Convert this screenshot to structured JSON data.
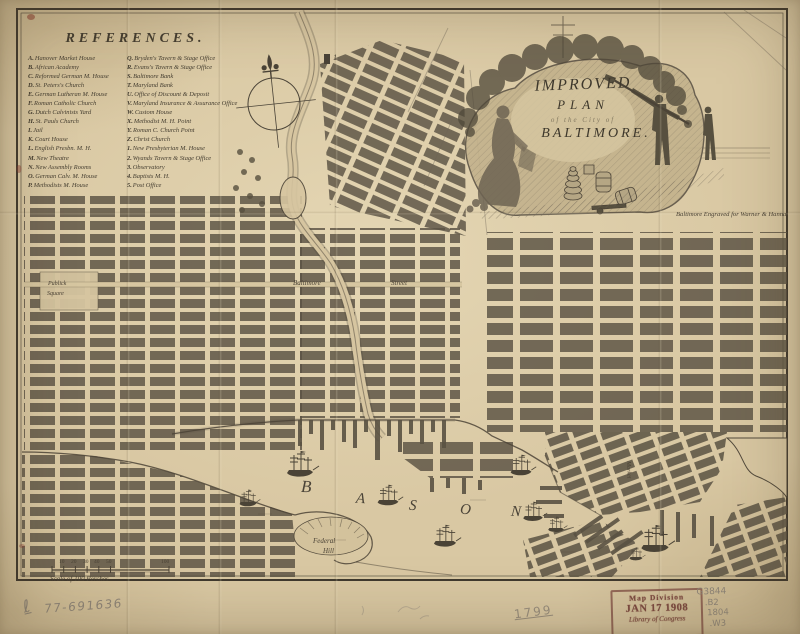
{
  "references": {
    "title": "REFERENCES.",
    "left": [
      {
        "key": "A.",
        "label": "Hanover Market House"
      },
      {
        "key": "B.",
        "label": "African Academy"
      },
      {
        "key": "C.",
        "label": "Reformed German M. House"
      },
      {
        "key": "D.",
        "label": "St. Peters's Church"
      },
      {
        "key": "E.",
        "label": "German Lutheran M. House"
      },
      {
        "key": "F.",
        "label": "Roman Catholic Church"
      },
      {
        "key": "G.",
        "label": "Dutch Calvinists Yard"
      },
      {
        "key": "H.",
        "label": "St. Pauls Church"
      },
      {
        "key": "I.",
        "label": "Jail"
      },
      {
        "key": "K.",
        "label": "Court House"
      },
      {
        "key": "L.",
        "label": "English Presbn. M. H."
      },
      {
        "key": "M.",
        "label": "New Theatre"
      },
      {
        "key": "N.",
        "label": "New Assembly Rooms"
      },
      {
        "key": "O.",
        "label": "German Calv. M. House"
      },
      {
        "key": "P.",
        "label": "Methodists M. House"
      }
    ],
    "right": [
      {
        "key": "Q.",
        "label": "Bryden's Tavern & Stage Office"
      },
      {
        "key": "R.",
        "label": "Evans's Tavern & Stage Office"
      },
      {
        "key": "S.",
        "label": "Baltimore Bank"
      },
      {
        "key": "T.",
        "label": "Maryland Bank"
      },
      {
        "key": "U.",
        "label": "Office of Discount & Deposit"
      },
      {
        "key": "V.",
        "label": "Maryland Insurance & Assurance Office"
      },
      {
        "key": "W.",
        "label": "Custom House"
      },
      {
        "key": "X.",
        "label": "Methodist M. H. Point"
      },
      {
        "key": "Y.",
        "label": "Roman C. Church Point"
      },
      {
        "key": "Z.",
        "label": "Christ Church"
      },
      {
        "key": "1.",
        "label": "New Presbyterian M. House"
      },
      {
        "key": "2.",
        "label": "Wyands Tavern & Stage Office"
      },
      {
        "key": "3.",
        "label": "Observatory"
      },
      {
        "key": "4.",
        "label": "Baptists M. H."
      },
      {
        "key": "5.",
        "label": "Post Office"
      }
    ]
  },
  "cartouche": {
    "line1": "IMPROVED",
    "line2": "PLAN",
    "line3": "of the City of",
    "line4": "BALTIMORE.",
    "credit": "Baltimore Engraved for Warner & Hanna."
  },
  "map_labels": {
    "bason_letters": [
      "B",
      "A",
      "S",
      "O",
      "N"
    ],
    "federal_hill_line1": "Federal",
    "federal_hill_line2": "Hill",
    "street_left": "Baltimore",
    "street_right": "Street",
    "square_line1": "Publick",
    "square_line2": "Square",
    "market_street": "Market",
    "marker": "1"
  },
  "scale": {
    "ticks": [
      "10",
      "20",
      "30",
      "40",
      "50",
      "100"
    ],
    "caption": "Scale of 100 Perches"
  },
  "annotations": {
    "pencil_prefix": "ℓ",
    "accession": "77-691636",
    "year": "1799",
    "stamp_line1": "Map Division",
    "stamp_line2": "JAN 17 1908",
    "stamp_line3": "Library of Congress",
    "call_line1": "G3844",
    "call_line2": ".B2",
    "call_line3": "1804",
    "call_line4": ".W3"
  },
  "colors": {
    "paper": "#d7c6a1",
    "ink": "#4b4336",
    "stamp": "#7c4a40",
    "pencil": "#8d8477"
  }
}
